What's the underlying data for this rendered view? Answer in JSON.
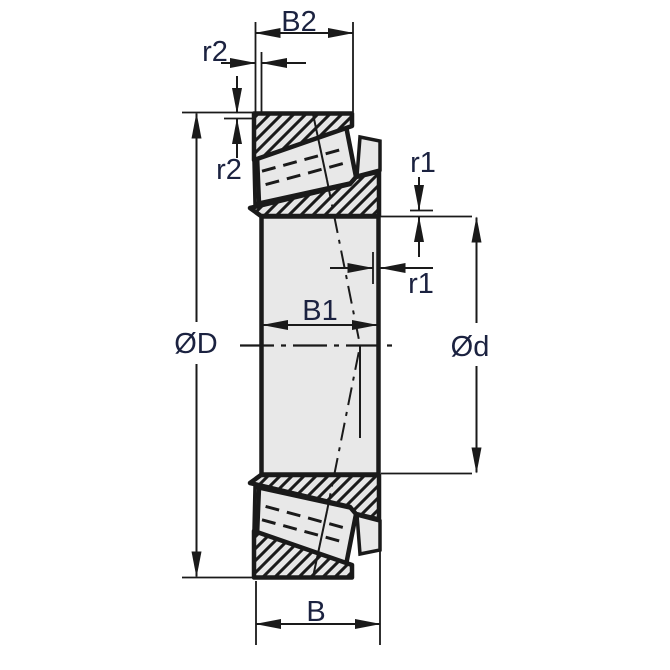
{
  "drawing": {
    "labels": {
      "cup_width": "B2",
      "cup_chamfer_axial": "r2",
      "cup_chamfer_radial": "r2",
      "cone_chamfer_radial": "r1",
      "cone_chamfer_axial": "r1",
      "cone_width": "B1",
      "outer_diameter": "ØD",
      "bore_diameter": "Ød",
      "overall_width": "B"
    },
    "colors": {
      "background": "#ffffff",
      "section_fill": "#e8e8e8",
      "line": "#1a1a1a",
      "label_text": "#1b2240"
    }
  }
}
